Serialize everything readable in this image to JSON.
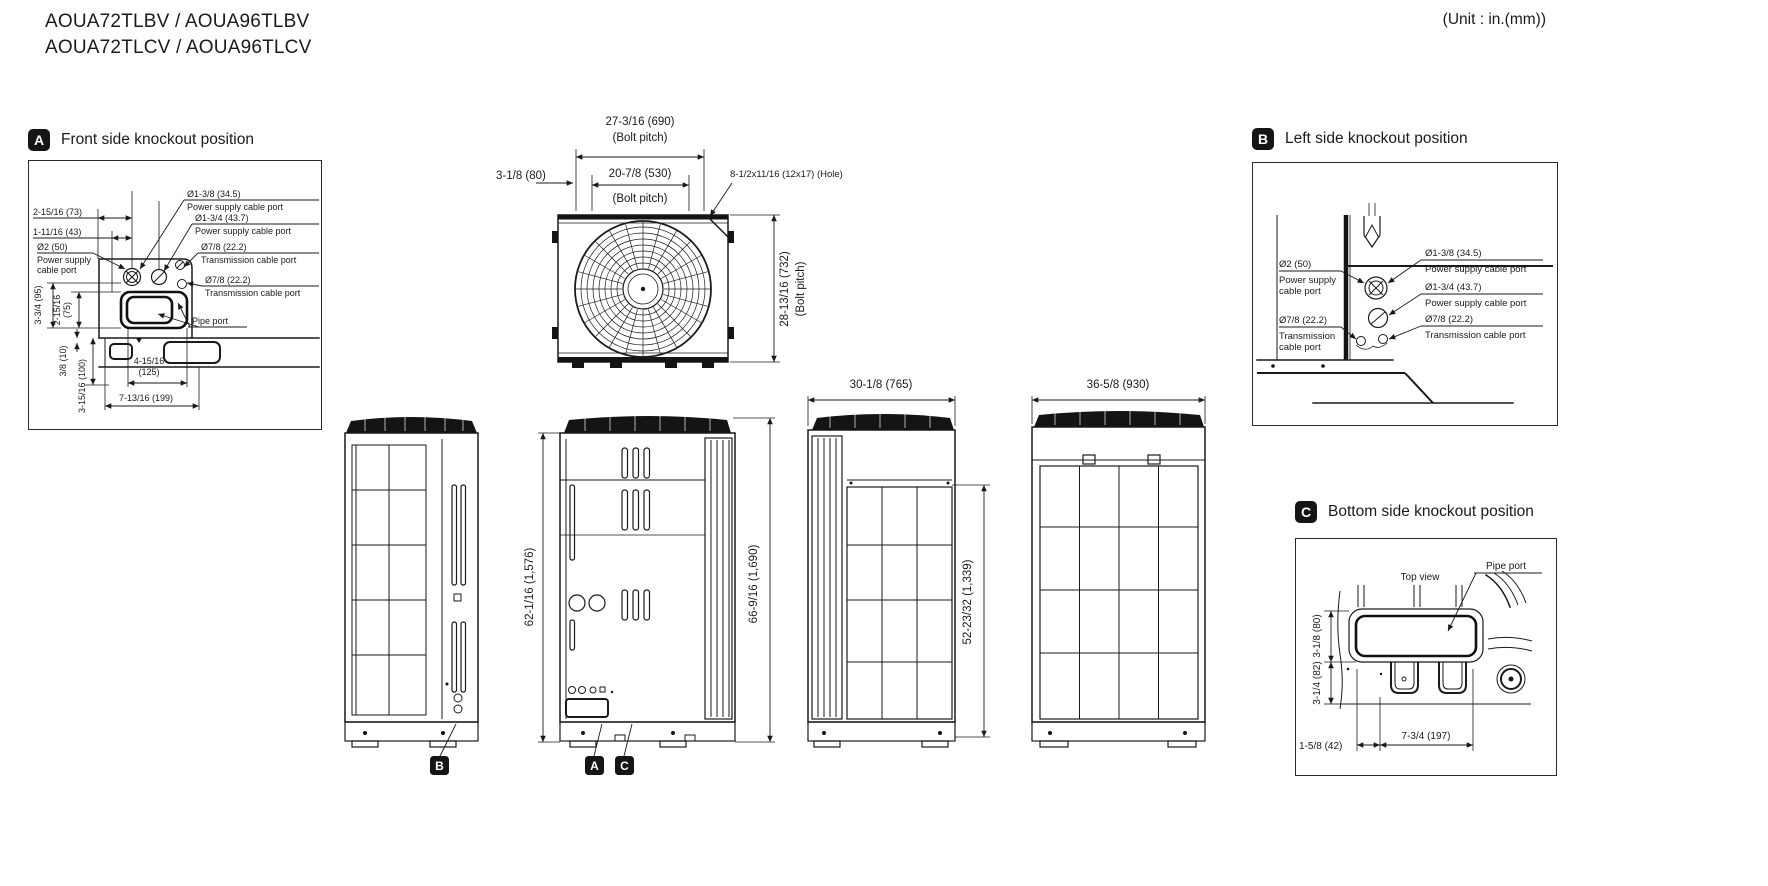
{
  "header": {
    "model_line1": "AOUA72TLBV / AOUA96TLBV",
    "model_line2": "AOUA72TLCV / AOUA96TLCV",
    "unit_note": "(Unit : in.(mm))"
  },
  "ports": {
    "power_full": "Power supply cable port",
    "power_l1": "Power supply",
    "power_l2": "cable port",
    "trans_full": "Transmission cable port",
    "trans_l1": "Transmission",
    "trans_l2": "cable  port",
    "pipe": "Pipe port"
  },
  "section_a": {
    "badge": "A",
    "title": "Front side knockout position",
    "dims": {
      "d73": "2-15/16 (73)",
      "d43": "1-11/16 (43)",
      "d50": "Ø2 (50)",
      "d345": "Ø1-3/8 (34.5)",
      "d437": "Ø1-3/4 (43.7)",
      "d222": "Ø7/8 (22.2)",
      "v95": "3-3/4 (95)",
      "v75a": "2-15/16",
      "v75b": "(75)",
      "v10": "3/8 (10)",
      "v100": "3-15/16 (100)",
      "w125a": "4-15/16",
      "w125b": "(125)",
      "w199": "7-13/16 (199)"
    }
  },
  "top_view": {
    "d690": "27-3/16 (690)",
    "bolt_pitch": "(Bolt pitch)",
    "d80": "3-1/8 (80)",
    "d530": "20-7/8 (530)",
    "hole": "8-1/2x11/16 (12x17) (Hole)",
    "d732": "28-13/16 (732)"
  },
  "section_b": {
    "badge": "B",
    "title": "Left side knockout position",
    "dims": {
      "d50": "Ø2 (50)",
      "d222": "Ø7/8 (22.2)",
      "d345": "Ø1-3/8 (34.5)",
      "d437": "Ø1-3/4 (43.7)"
    }
  },
  "views": {
    "d1576": "62-1/16 (1,576)",
    "d1690": "66-9/16 (1,690)",
    "d765": "30-1/8 (765)",
    "d930": "36-5/8 (930)",
    "d1339": "52-23/32 (1,339)",
    "badge_b": "B",
    "badge_a": "A",
    "badge_c": "C"
  },
  "section_c": {
    "badge": "C",
    "title": "Bottom side knockout position",
    "top_view": "Top view",
    "dims": {
      "v80": "3-1/8 (80)",
      "v82": "3-1/4 (82)",
      "w42": "1-5/8 (42)",
      "w197": "7-3/4 (197)"
    }
  },
  "colors": {
    "ink": "#1a1a1a",
    "badge_bg": "#151515",
    "badge_fg": "#ffffff"
  }
}
